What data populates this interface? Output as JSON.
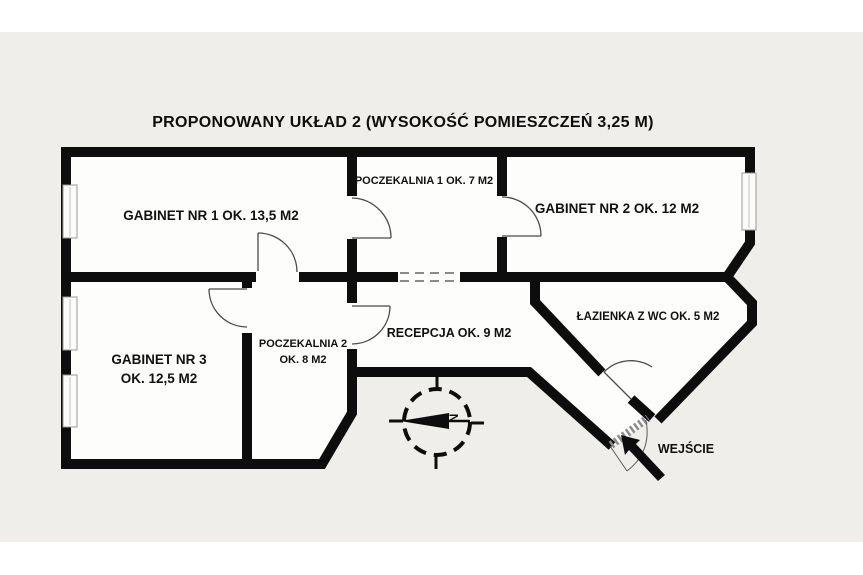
{
  "title": "PROPONOWANY UKŁAD 2 (WYSOKOŚĆ POMIESZCZEŃ 3,25 M)",
  "rooms": {
    "gabinet1": {
      "label": "GABINET NR 1 OK. 13,5 M2"
    },
    "poczekalnia1": {
      "label": "POCZEKALNIA 1 OK. 7 M2"
    },
    "gabinet2": {
      "label": "GABINET NR 2 OK. 12 M2"
    },
    "gabinet3": {
      "line1": "GABINET NR 3",
      "line2": "OK. 12,5 M2"
    },
    "poczekalnia2": {
      "line1": "POCZEKALNIA 2",
      "line2": "OK. 8 M2"
    },
    "recepcja": {
      "label": "RECEPCJA OK. 9 M2"
    },
    "lazienka": {
      "label": "ŁAZIENKA Z WC OK. 5 M2"
    }
  },
  "annotations": {
    "entrance_label": "WEJŚCIE",
    "compass_north": "N"
  },
  "colors": {
    "sheet_background": "#efeeea",
    "page_margin": "#ffffff",
    "wall": "#0d0d0d",
    "room_fill": "#fdfdfc",
    "text": "#111111"
  }
}
